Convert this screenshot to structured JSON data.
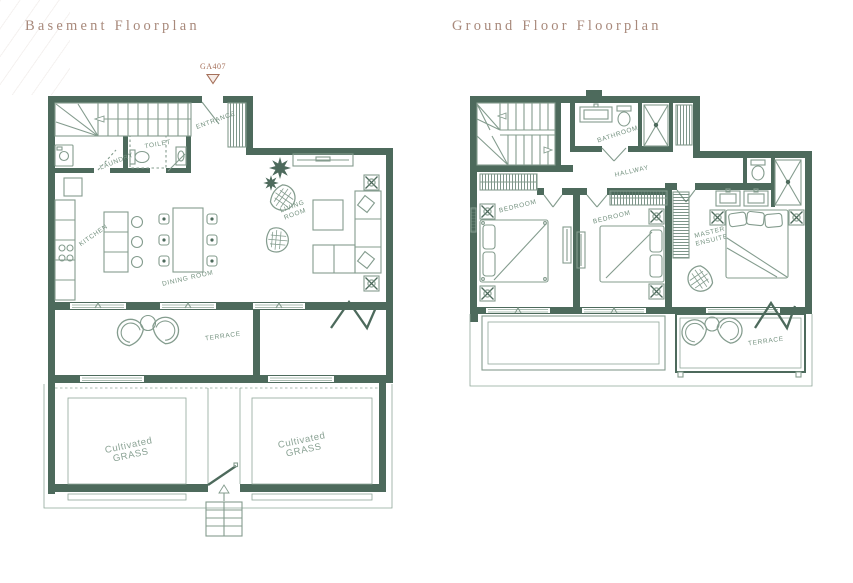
{
  "page": {
    "basement_title": "Basement Floorplan",
    "ground_title": "Ground Floor Floorplan",
    "marker_label": "GA407"
  },
  "colors": {
    "wall": "#4d6a5c",
    "furniture_line": "#849c8e",
    "room_label": "#74917f",
    "grass_label": "#8aa294",
    "title": "#a8897b",
    "marker": "#a5705a",
    "background": "#ffffff"
  },
  "basement": {
    "labels": {
      "entrance": "ENTRANCE",
      "laundry": "LAUNDRY",
      "toilet": "TOILET",
      "kitchen": "KITCHEN",
      "dining_room": "DINING ROOM",
      "living_room": "LIVING ROOM",
      "terrace": "TERRACE",
      "grass_left_line1": "Cultivated",
      "grass_left_line2": "GRASS",
      "grass_right_line1": "Cultivated",
      "grass_right_line2": "GRASS"
    }
  },
  "ground_floor": {
    "labels": {
      "bathroom": "BATHROOM",
      "hallway": "HALLWAY",
      "bedroom_left": "BEDROOM",
      "bedroom_middle": "BEDROOM",
      "master_ensuite": "MASTER ENSUITE",
      "terrace": "TERRACE"
    }
  }
}
